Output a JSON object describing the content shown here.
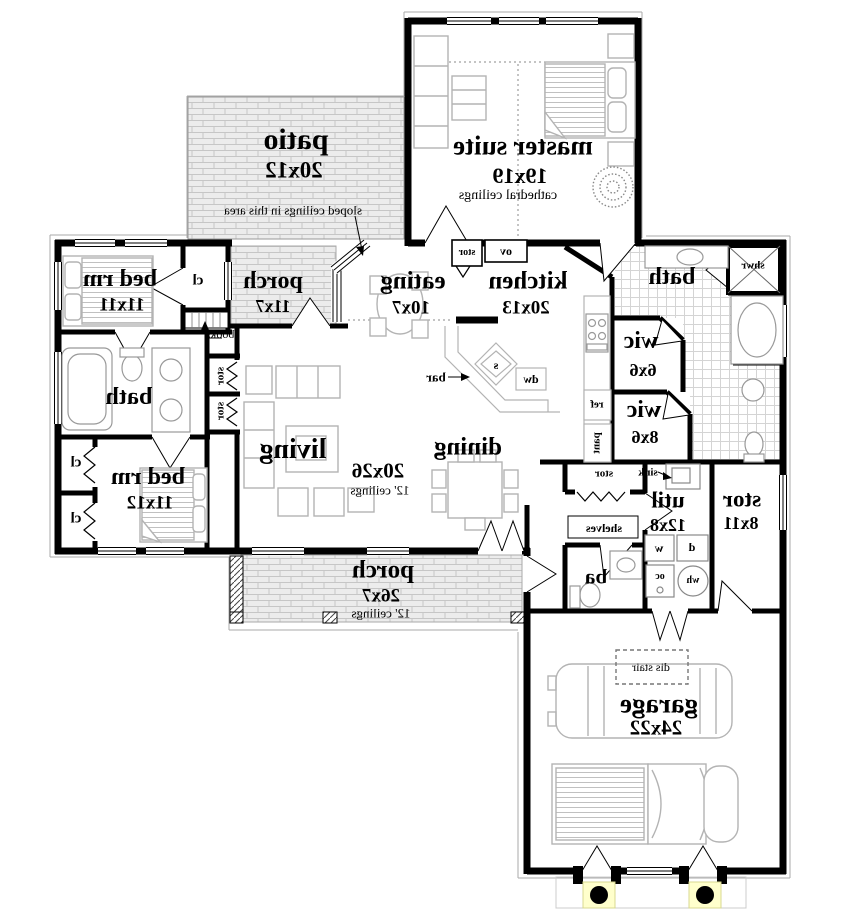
{
  "colors": {
    "wall": "#000000",
    "furniture_line": "#b3b3b3",
    "brick_line": "#c6c6c6",
    "tile_line": "#d4d4d4",
    "column_pad": "#ffffcc"
  },
  "labels": {
    "master_suite": {
      "name": "master suite",
      "dims": "19x19",
      "note": "cathedral ceilings"
    },
    "patio": {
      "name": "patio",
      "dims": "20x12",
      "note": "sloped ceilings in this area"
    },
    "bed_rm_1": {
      "name": "bed rm",
      "dims": "11x11"
    },
    "closet": "cl",
    "books": "books",
    "porch_side": {
      "name": "porch",
      "dims": "11x7"
    },
    "eating": {
      "name": "eating",
      "dims": "10x7"
    },
    "kitchen": {
      "name": "kitchen",
      "dims": "20x13"
    },
    "stor_cab": "stor",
    "oven": "ov",
    "island_sink": "s",
    "dishwasher": "dw",
    "bar": "bar",
    "ref": "ref",
    "pantry": "pant",
    "bath_master": "bath",
    "shower": "shwr",
    "wic1": {
      "name": "wic",
      "dims": "6x6"
    },
    "wic2": {
      "name": "wic",
      "dims": "8x6"
    },
    "bath_hall": "bath",
    "bed_rm_2": {
      "name": "bed rm",
      "dims": "11x12"
    },
    "living": {
      "name": "living",
      "dims": "20x26",
      "note": "12' ceilings"
    },
    "stor_closet": "stor",
    "dining": "dining",
    "porch_front": {
      "name": "porch",
      "dims": "26x7",
      "note": "12' ceilings"
    },
    "hall_stor": "stor",
    "sink": "sink",
    "shelves": "shelves",
    "ba": "ba",
    "util": {
      "name": "util",
      "dims": "12x8"
    },
    "washer": "w",
    "dryer": "d",
    "oc": "oc",
    "water_heater": "wh",
    "stor_room": {
      "name": "stor",
      "dims": "8x11"
    },
    "garage": {
      "name": "garage",
      "dims": "24x22"
    },
    "dis_stair": "dis stair"
  }
}
